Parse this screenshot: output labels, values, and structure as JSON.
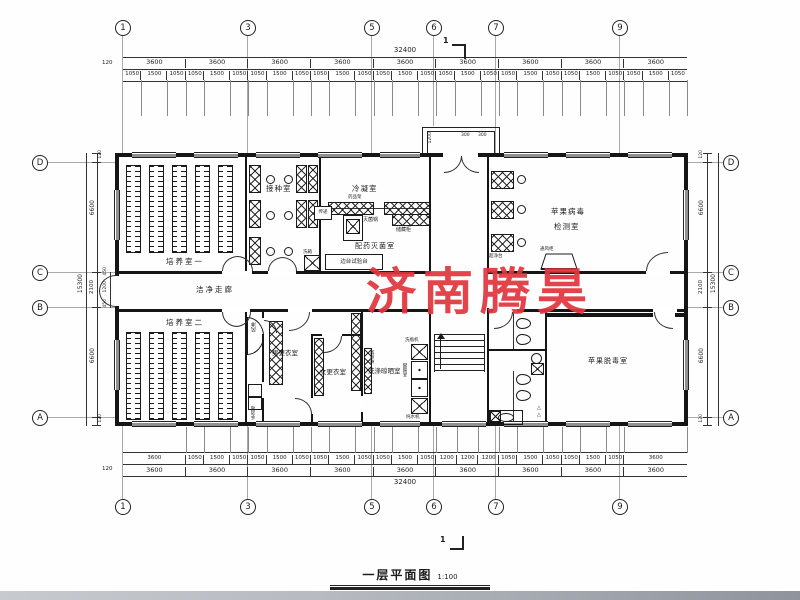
{
  "title": {
    "name": "一层平面图",
    "scale": "1:100"
  },
  "watermark": {
    "text": "济南腾昊",
    "color": "#e2363e"
  },
  "axes": {
    "top": [
      "1",
      "3",
      "5",
      "6",
      "7",
      "9"
    ],
    "bottom": [
      "1",
      "3",
      "5",
      "6",
      "7",
      "9"
    ],
    "left": [
      "D",
      "C",
      "B",
      "A"
    ],
    "right": [
      "D",
      "C",
      "B",
      "A"
    ],
    "section": "1"
  },
  "dims": {
    "top": {
      "total": "32400",
      "edge": "120",
      "bays": [
        "3600",
        "3600",
        "3600",
        "3600",
        "3600",
        "3600",
        "3600",
        "3600",
        "3600"
      ],
      "fine": [
        "1050",
        "1500",
        "1050",
        "1050",
        "1500",
        "1050",
        "1050",
        "1500",
        "1050",
        "1050",
        "1500",
        "1050",
        "1050",
        "1500",
        "1050",
        "1050",
        "1500",
        "1050",
        "1050",
        "1500",
        "1050",
        "1050",
        "1500",
        "1050",
        "1050",
        "1500",
        "1050"
      ]
    },
    "bottom": {
      "total": "32400",
      "edge": "120",
      "bays": [
        "3600",
        "3600",
        "3600",
        "3600",
        "3600",
        "3600",
        "3600",
        "3600",
        "3600"
      ],
      "fine": [
        "3600",
        "1050",
        "1500",
        "1050",
        "1050",
        "1500",
        "1050",
        "1050",
        "1500",
        "1050",
        "1050",
        "1500",
        "1050",
        "1200",
        "1200",
        "1200",
        "1050",
        "1500",
        "1050",
        "1050",
        "1500",
        "1050",
        "3600"
      ]
    },
    "left": {
      "total": "15300",
      "segs": [
        "120",
        "6600",
        "2100",
        "6600",
        "120"
      ],
      "sub": [
        "450",
        "1200",
        "450"
      ]
    },
    "right": {
      "total": "15300",
      "segs": [
        "120",
        "6600",
        "2100",
        "6600",
        "120"
      ]
    },
    "porch": {
      "depth": "1200",
      "a": "300",
      "b": "300"
    }
  },
  "rooms": {
    "culture1": "培养室一",
    "culture2": "培养室二",
    "inoculation": "接种室",
    "condense": "冷凝室",
    "prep": "配药灭菌室",
    "detect1": "苹果病毒",
    "detect2": "检测室",
    "detox": "苹果脱毒室",
    "corridor": "洁净走廊",
    "men": "男更衣室",
    "women": "女更衣室",
    "wash": "洗涤晾晒室",
    "shower": "风淋",
    "sanitize": "手消毒"
  },
  "equip": {
    "pass": "传递",
    "rack": "药品架",
    "sterilizer": "灭菌锅",
    "cabinet": "储藏柜",
    "bench": "边台试验台",
    "washbox": "洗箱",
    "cleanbench": "超净台",
    "fume": "通风柜",
    "bottlewasher": "洗瓶机",
    "distiller": "蒸馏器",
    "purewater": "纯水机",
    "dryrack": "晾瓶架"
  }
}
